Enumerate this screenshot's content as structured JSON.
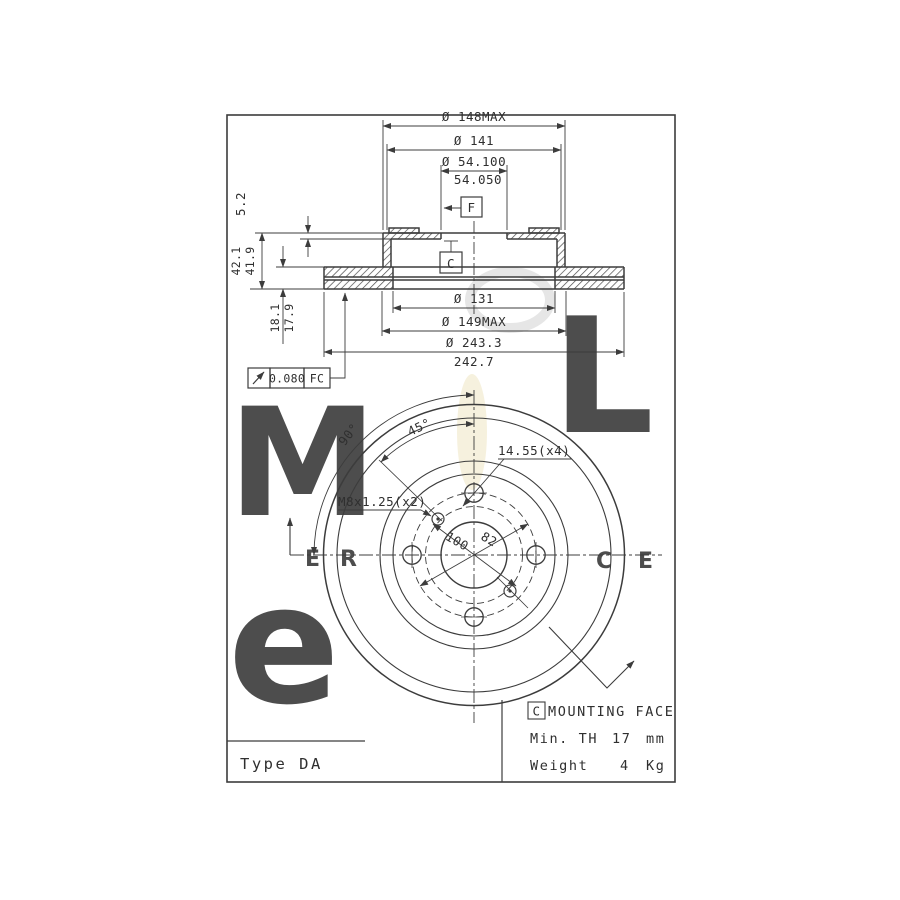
{
  "section_view": {
    "d148": "Ø 148MAX",
    "d141": "Ø 141",
    "d54a": "Ø 54.100",
    "d54b": "54.050",
    "d131": "Ø 131",
    "d149": "Ø 149MAX",
    "d243a": "Ø 243.3",
    "d243b": "242.7",
    "t52": "5.2",
    "t42a": "42.1",
    "t42b": "41.9",
    "t18a": "18.1",
    "t18b": "17.9",
    "datum_f": "F",
    "datum_c": "C",
    "tolerance": {
      "symbol": "runout-arrow",
      "value": "0.080",
      "datum": "FC"
    }
  },
  "front_view": {
    "angle_90": "90°",
    "angle_45": "45°",
    "thread_label": "M8x1.25(x2)",
    "bolt_hole_label": "14.55(x4)",
    "pcd_label": "100",
    "bore_circle_label": "82"
  },
  "title_block": {
    "type_label": "Type DA"
  },
  "notes_block": {
    "datum": "C",
    "heading": "MOUNTING FACE",
    "rows": [
      {
        "label": "Min. TH",
        "value": "17",
        "unit": "mm"
      },
      {
        "label": "Weight",
        "value": "4",
        "unit": "Kg"
      }
    ]
  },
  "watermark": {
    "glyphs": [
      "M",
      "L",
      "e",
      "E",
      "R",
      "C",
      "E"
    ]
  },
  "colors": {
    "line": "#3c3c3c",
    "paper": "#ffffff",
    "watermark": "#dedede",
    "streak": "#f2eacb"
  }
}
